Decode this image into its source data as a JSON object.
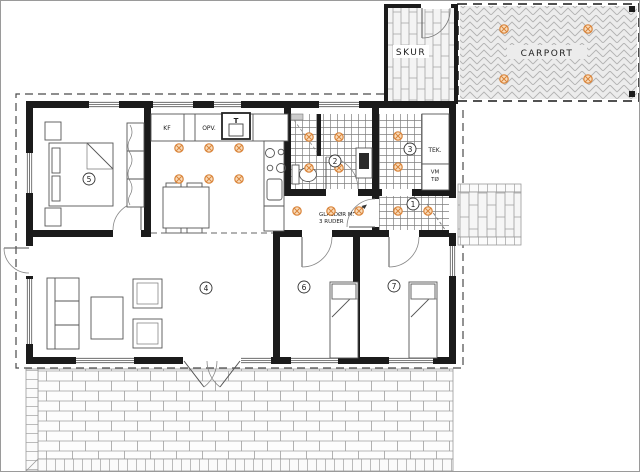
{
  "outbuildings": {
    "skur_label": "SKUR",
    "carport_label": "CARPORT"
  },
  "kitchen": {
    "fridge_label": "KF",
    "dishwasher_label": "OPV.",
    "oven_label": "T"
  },
  "utility": {
    "tek_label": "TEK.",
    "washer_label": "VM",
    "dryer_label": "TØ"
  },
  "annotations": {
    "glass_door_line1": "GLASDØR M.",
    "glass_door_line2": "3 RUDER"
  },
  "rooms": {
    "entry": "1",
    "bathroom": "2",
    "tech_room": "3",
    "living_room": "4",
    "main_bedroom": "5",
    "bedroom_left": "6",
    "bedroom_right": "7"
  },
  "colors": {
    "wall": "#1b1b1b",
    "light_accent": "#d9843a",
    "light_fill": "#f9dcbb",
    "pattern_line": "#a0a0a0"
  }
}
